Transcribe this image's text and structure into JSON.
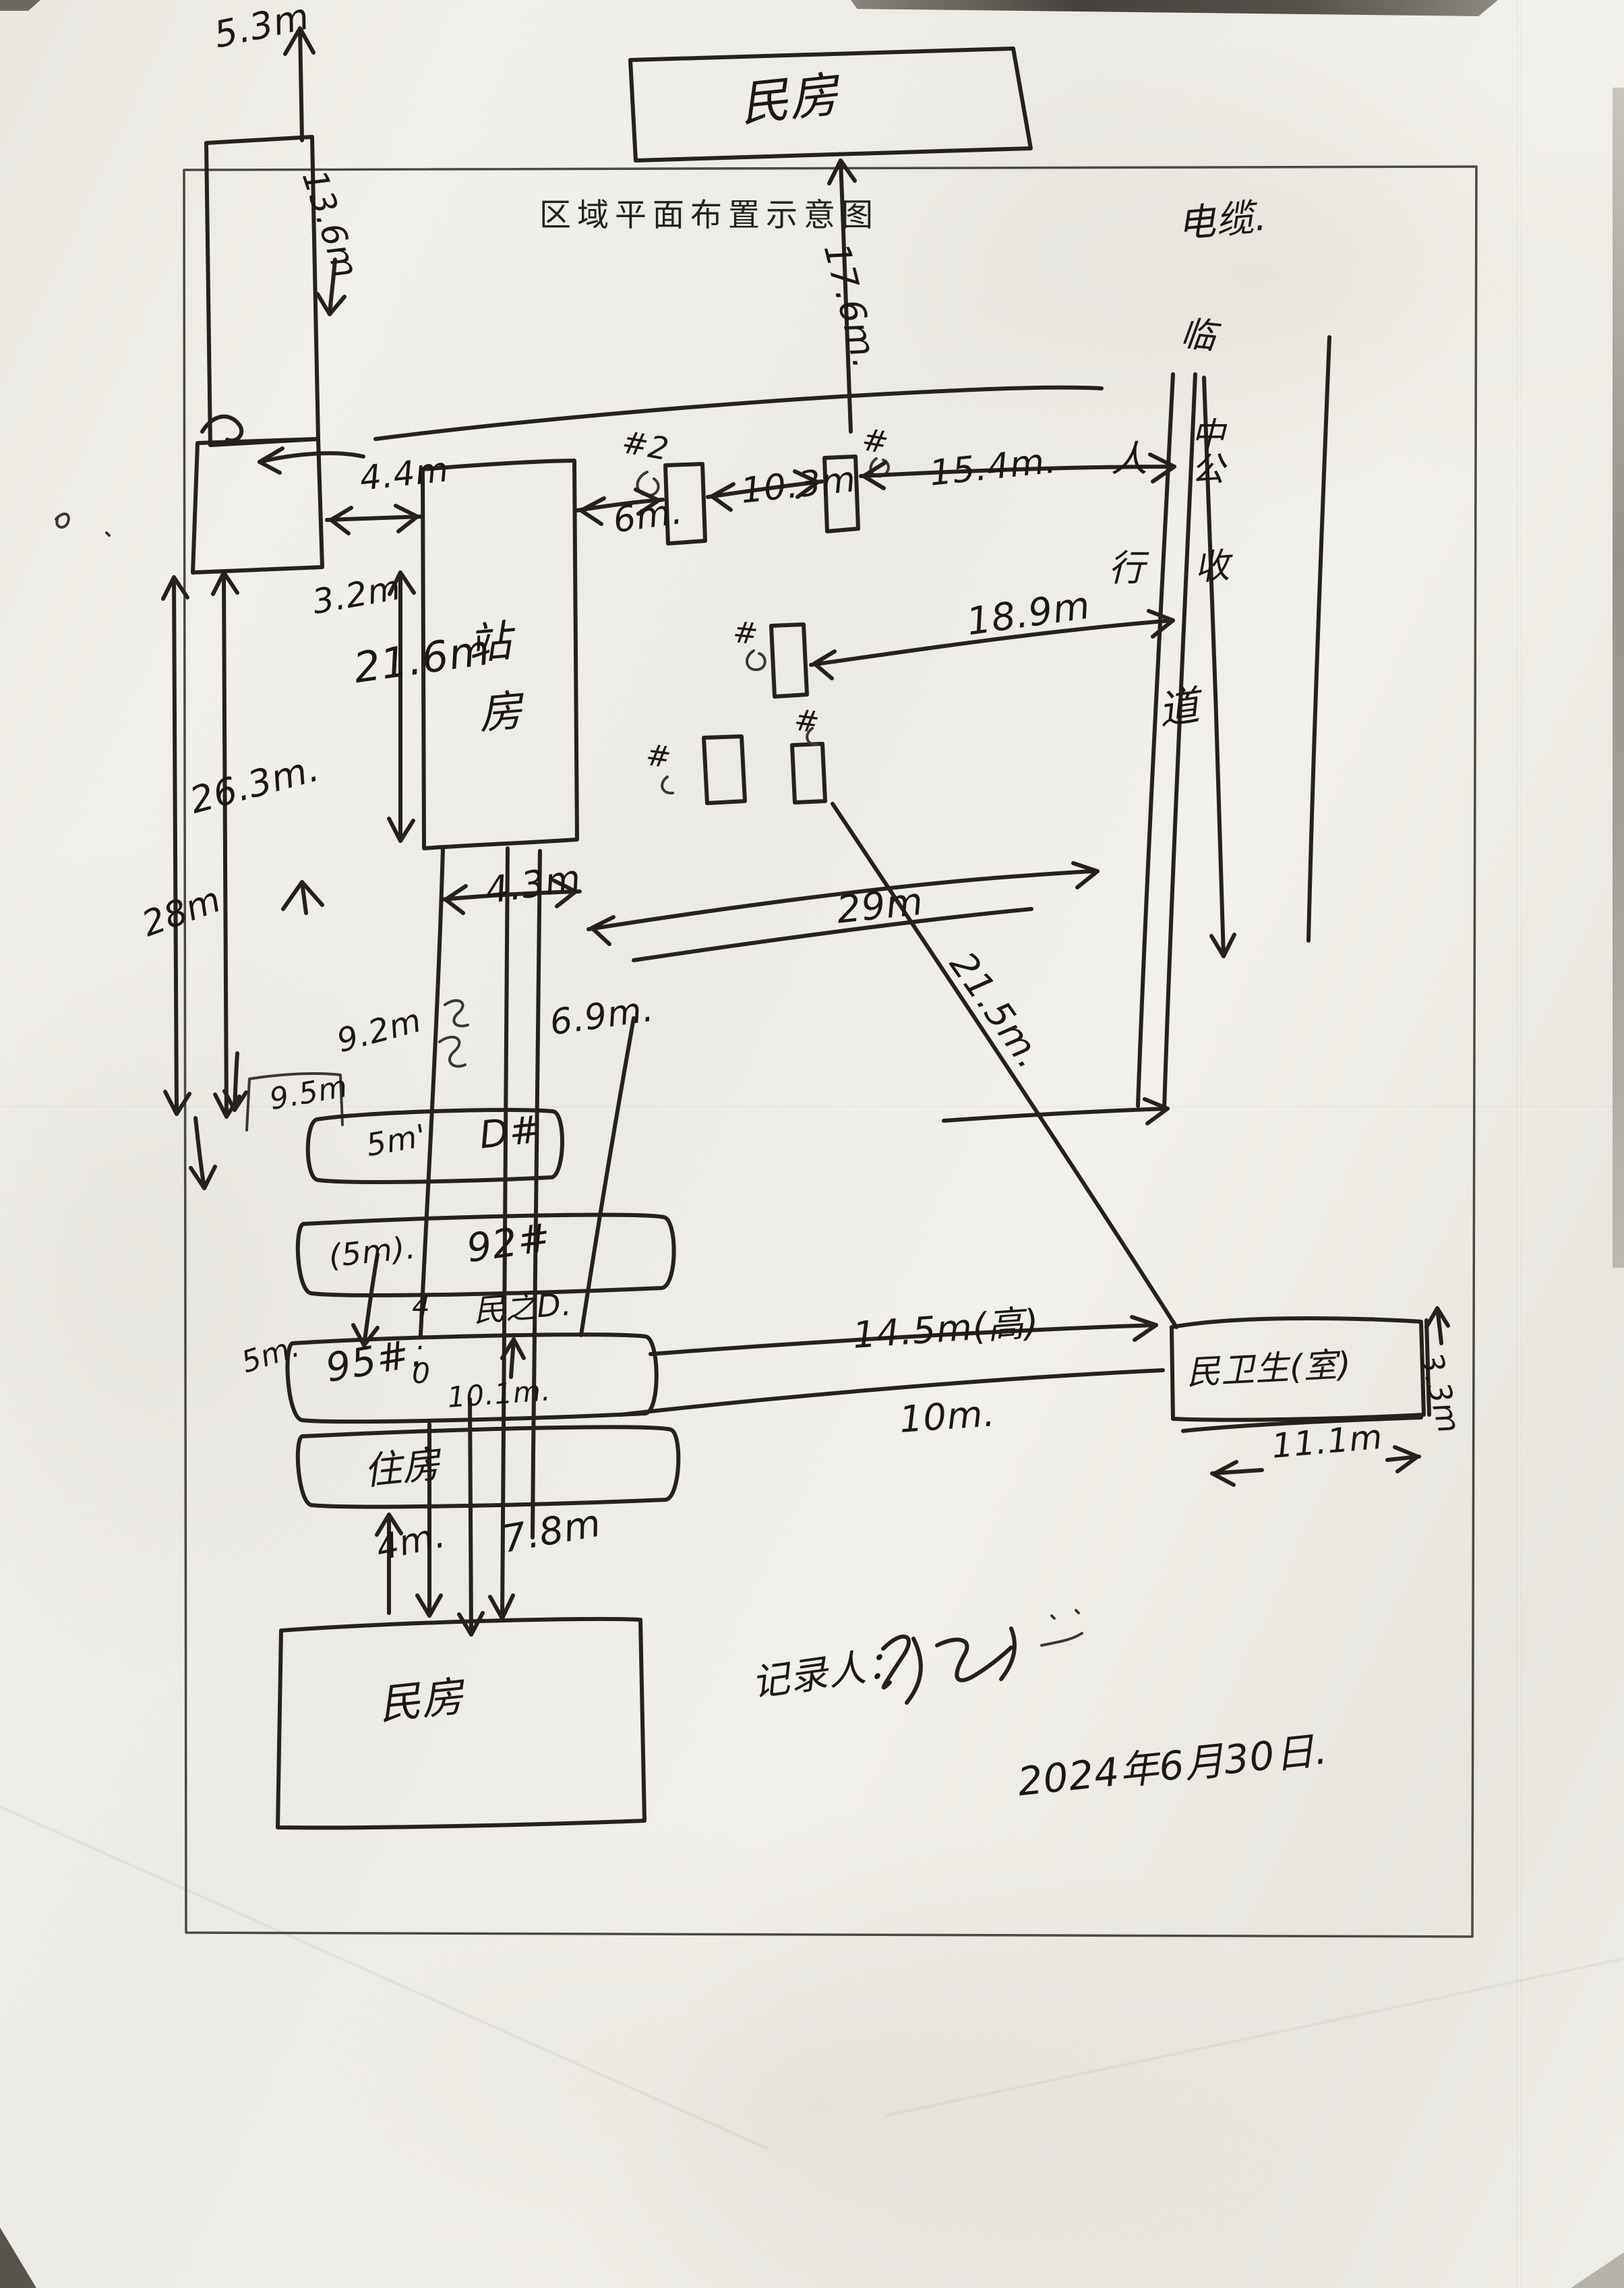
{
  "title": "区域平面布置示意图",
  "buildings": {
    "top_house": "民房",
    "station_house": [
      "站",
      "房"
    ],
    "row_d": {
      "size": "5m'",
      "tag": "D#"
    },
    "row_92": {
      "size": "(5m).",
      "tag": "92#"
    },
    "row_95": {
      "size": "5m.",
      "tag": "95#.",
      "width_below": "10.1m."
    },
    "row_housing": "住房",
    "bottom_house": "民房",
    "clinic": "民卫生(室)"
  },
  "roadside": {
    "cable_label": "电缆.",
    "pole_tags": [
      "#2",
      "#",
      "#",
      "#",
      "#"
    ],
    "column_notes": [
      "临",
      "中公",
      "收"
    ],
    "sidewalk": [
      "人",
      "行",
      "道"
    ]
  },
  "measurements": {
    "m5_3": "5.3m",
    "m13_6": "13.6m",
    "m17_6": "17.6m.",
    "m4_4": "4.4m",
    "m3_2": "3.2m",
    "m21_6": "21.6m",
    "m6": "6m.",
    "m10_3": "10.3m",
    "m15_4": "15.4m.",
    "m18_9": "18.9m",
    "m26_3": "26.3m.",
    "m28": "28m",
    "m4_3": "4.3m",
    "m6_9": "6.9m.",
    "m29": "29m",
    "m21_5": "21.5m.",
    "m9_2": "9.2m",
    "m9_5": "9.5m",
    "m14_5": "14.5m(高)",
    "m10": "10m.",
    "m3_3": "3.3m",
    "m11_1": "11.1m",
    "m4": "4m.",
    "m7_8": "7.8m"
  },
  "annotations": {
    "mid_note": "民之D.",
    "col_width": "4.0"
  },
  "footer": {
    "recorder_label": "记录人：",
    "date": "2024年6月30日."
  }
}
